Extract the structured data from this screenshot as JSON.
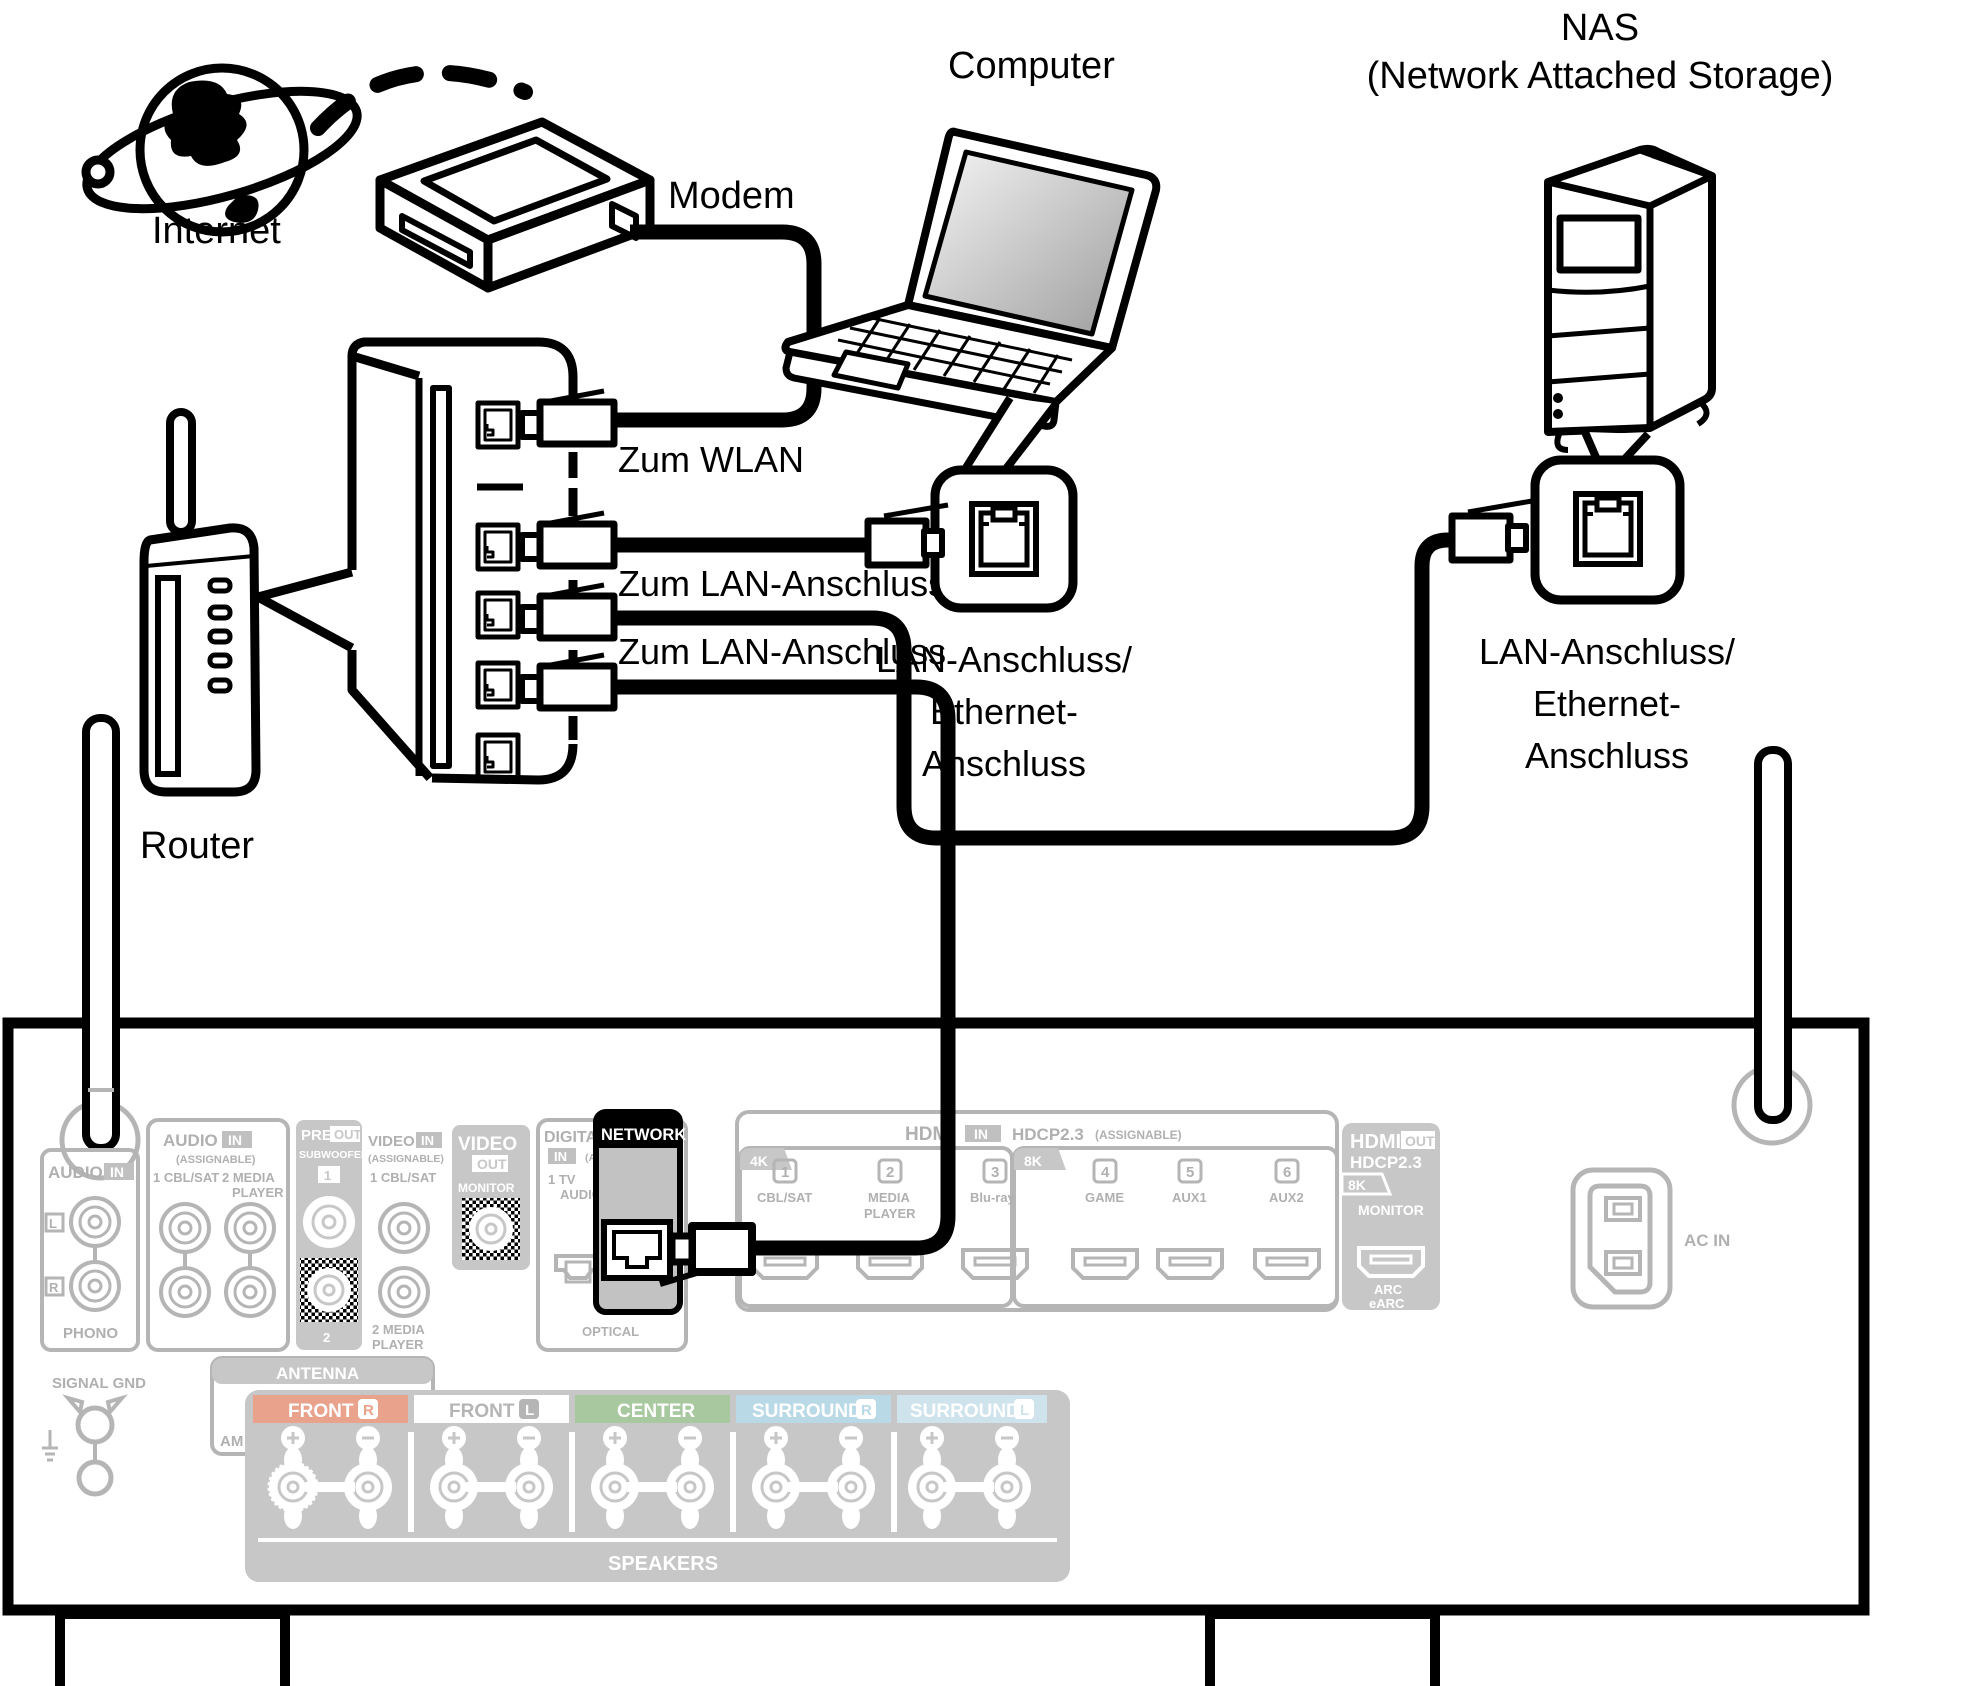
{
  "diagram": {
    "internet_label": "Internet",
    "modem_label": "Modem",
    "computer_label": "Computer",
    "nas_label_line1": "NAS",
    "nas_label_line2": "(Network Attached Storage)",
    "router_label": "Router",
    "to_wlan": "Zum WLAN",
    "to_lan_1": "Zum LAN-Anschluss",
    "to_lan_2": "Zum LAN-Anschluss",
    "computer_port_label": [
      "LAN-Anschluss/",
      "Ethernet-",
      "Anschluss"
    ],
    "nas_port_label": [
      "LAN-Anschluss/",
      "Ethernet-",
      "Anschluss"
    ]
  },
  "rear_panel": {
    "audio_in_phono": {
      "header_audio": "AUDIO",
      "header_in": "IN",
      "left": "L",
      "right": "R",
      "label": "PHONO"
    },
    "audio_in_assignable": {
      "header_audio": "AUDIO",
      "header_in": "IN",
      "assignable": "(ASSIGNABLE)",
      "input1": "1 CBL/SAT",
      "input2a": "2 MEDIA",
      "input2b": "PLAYER"
    },
    "pre_out": {
      "header_pre": "PRE",
      "header_out": "OUT",
      "subwoofer": "SUBWOOFER",
      "num1": "1",
      "num2": "2"
    },
    "video_in": {
      "header_video": "VIDEO",
      "header_in": "IN",
      "assignable": "(ASSIGNABLE)",
      "input1": "1 CBL/SAT",
      "input2a": "2 MEDIA",
      "input2b": "PLAYER"
    },
    "video_out": {
      "header_video": "VIDEO",
      "header_out": "OUT",
      "monitor": "MONITOR"
    },
    "digital_audio": {
      "header": "DIGITAL AUDIO",
      "header_in": "IN",
      "assignable": "(ASSIGNABLE)",
      "input1a": "1  TV",
      "input1b": "AUDIO",
      "input2": "2 CBL/SAT",
      "optical": "OPTICAL"
    },
    "network": {
      "label": "NETWORK"
    },
    "signal_gnd": {
      "label": "SIGNAL GND"
    },
    "antenna": {
      "label": "ANTENNA",
      "am": "AM",
      "fm": "FM",
      "ohm": "75Ω"
    },
    "hdmi_in": {
      "hdmi": "HDMI",
      "in": "IN",
      "hdcp": "HDCP2.3",
      "assignable": "(ASSIGNABLE)",
      "k4": "4K",
      "k8": "8K",
      "ports": [
        {
          "num": "1",
          "name": "CBL/SAT",
          "name2": ""
        },
        {
          "num": "2",
          "name": "MEDIA",
          "name2": "PLAYER"
        },
        {
          "num": "3",
          "name": "Blu-ray",
          "name2": ""
        },
        {
          "num": "4",
          "name": "GAME",
          "name2": ""
        },
        {
          "num": "5",
          "name": "AUX1",
          "name2": ""
        },
        {
          "num": "6",
          "name": "AUX2",
          "name2": ""
        }
      ]
    },
    "hdmi_out": {
      "hdmi": "HDMI",
      "out": "OUT",
      "hdcp": "HDCP2.3",
      "k8": "8K",
      "monitor": "MONITOR",
      "arc": "ARC",
      "earc": "eARC"
    },
    "ac_in": "AC IN",
    "speakers": {
      "label": "SPEAKERS",
      "channels": [
        {
          "name": "FRONT",
          "ch": "R"
        },
        {
          "name": "FRONT",
          "ch": "L"
        },
        {
          "name": "CENTER",
          "ch": ""
        },
        {
          "name": "SURROUND",
          "ch": "R"
        },
        {
          "name": "SURROUND",
          "ch": "L"
        }
      ]
    }
  },
  "colors": {
    "line_black": "#000000",
    "panel_gray": "#b5b5b5",
    "text_gray": "#aeaeae",
    "block_gray": "#c7c7c7",
    "network_body": "#c2c2c2",
    "front_r": "#e9a28b",
    "front_l": "#ffffff",
    "center": "#a8c8a0",
    "surround_r": "#b9d9e6",
    "surround_l": "#cfe3ed"
  }
}
